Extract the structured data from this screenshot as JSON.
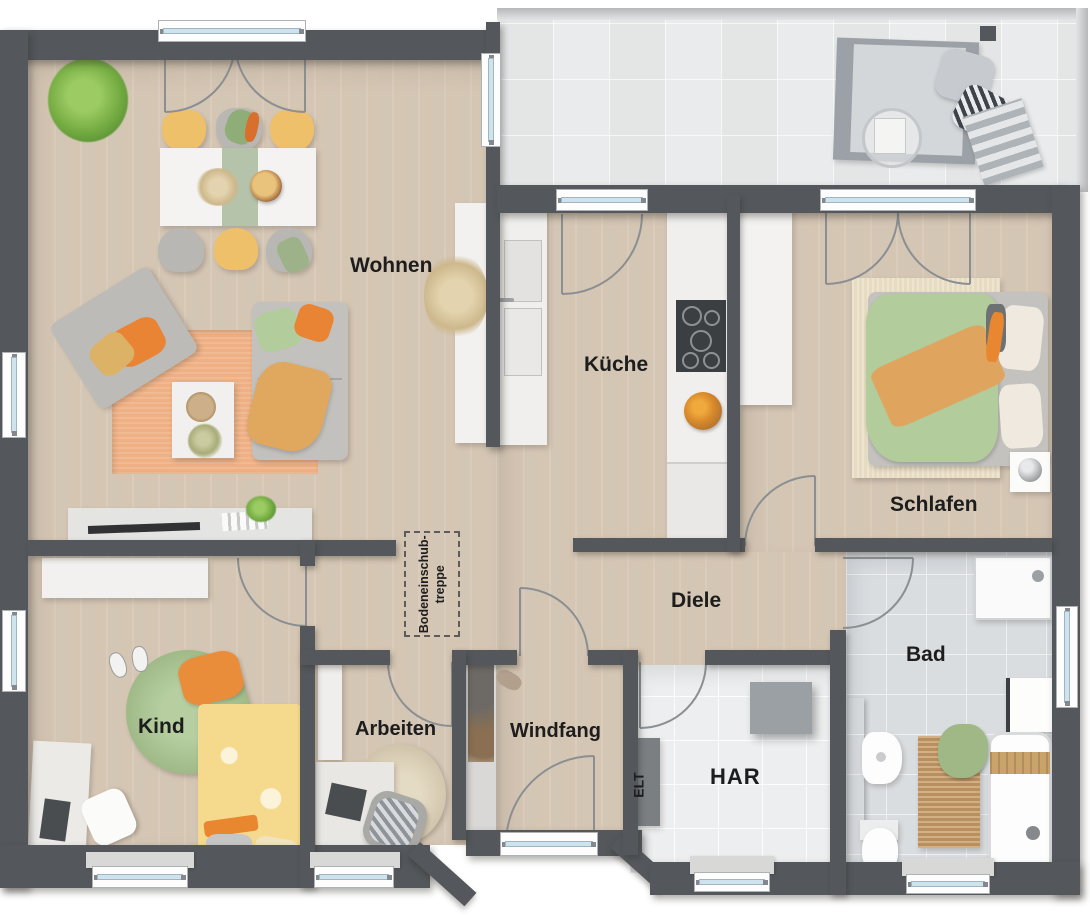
{
  "rooms": {
    "wohnen": "Wohnen",
    "kueche": "Küche",
    "schlafen": "Schlafen",
    "diele": "Diele",
    "bad": "Bad",
    "kind": "Kind",
    "arbeiten": "Arbeiten",
    "windfang": "Windfang",
    "har": "HAR",
    "elt": "ELT"
  },
  "annotations": {
    "attic_line1": "Bodeneinschub-",
    "attic_line2": "treppe"
  },
  "colors": {
    "wall": "#54585c",
    "wood_floor": "#d9cbba",
    "terrace_tile": "#e9ebec",
    "bath_tile": "#dadde0",
    "har_tile": "#eceeef",
    "window_glass": "#cfe3ee",
    "rug_living": "#eeb084",
    "rug_kids": "#a9c690",
    "accent_orange": "#ea8d3a",
    "accent_yellow": "#efc06a",
    "accent_green": "#b2cc9b"
  }
}
